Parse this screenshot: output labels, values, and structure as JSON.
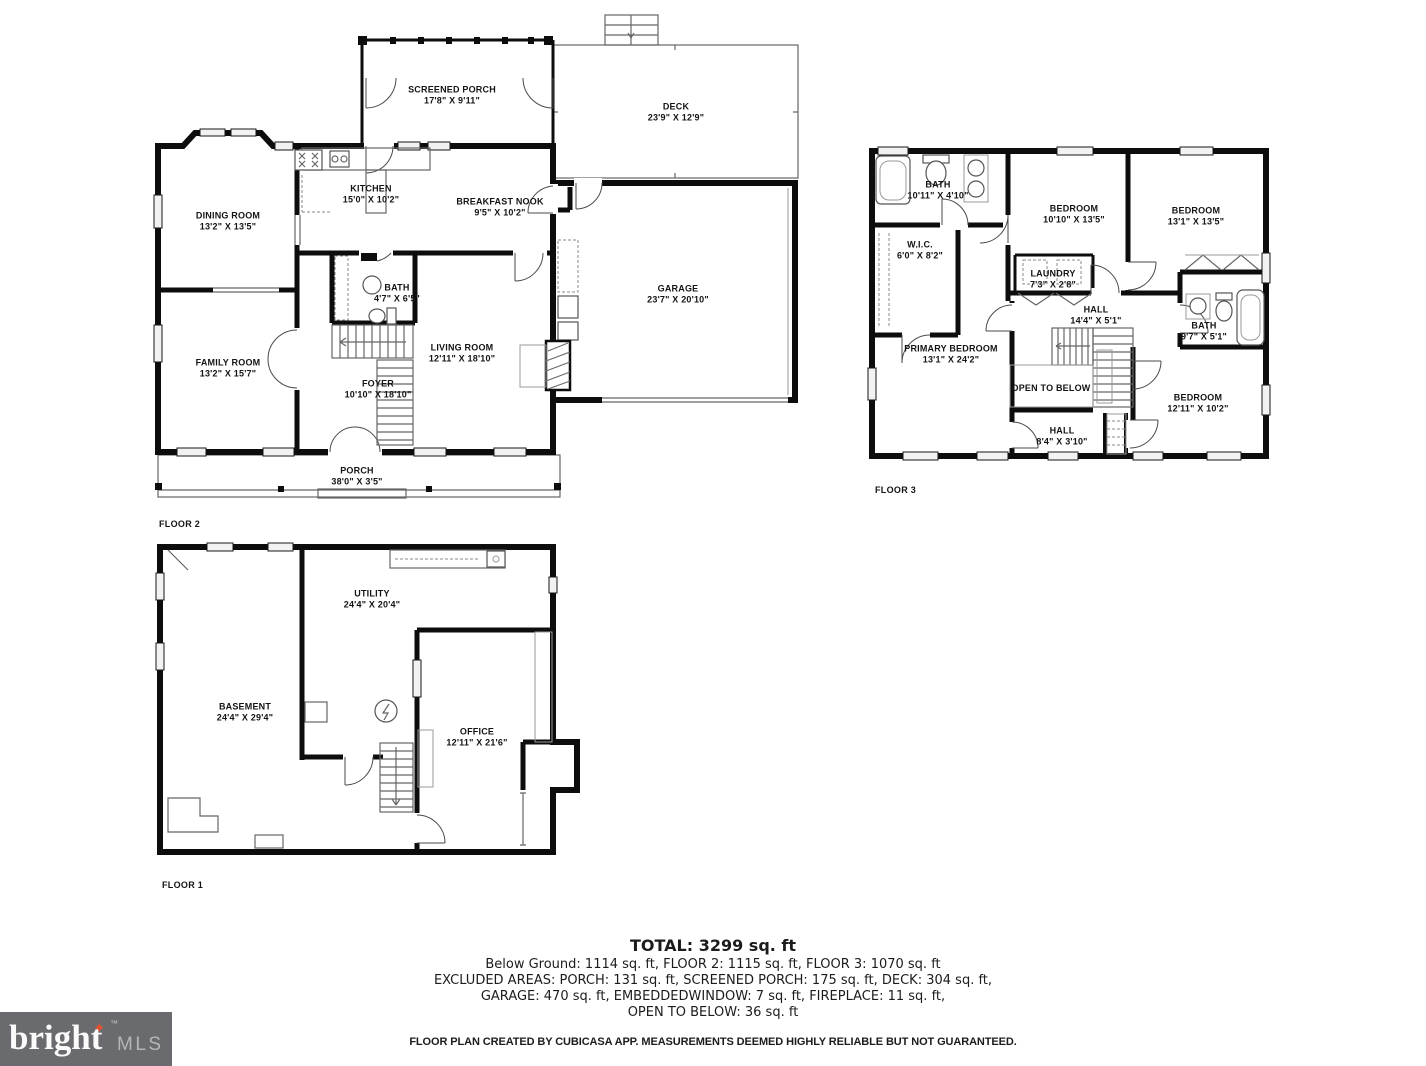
{
  "floors": [
    {
      "label": "FLOOR 2",
      "rooms": [
        {
          "name": "SCREENED PORCH",
          "dims": "17'8\" X 9'11\""
        },
        {
          "name": "DECK",
          "dims": "23'9\" X 12'9\""
        },
        {
          "name": "DINING ROOM",
          "dims": "13'2\" X 13'5\""
        },
        {
          "name": "KITCHEN",
          "dims": "15'0\" X 10'2\""
        },
        {
          "name": "BREAKFAST NOOK",
          "dims": "9'5\" X 10'2\""
        },
        {
          "name": "GARAGE",
          "dims": "23'7\" X 20'10\""
        },
        {
          "name": "BATH",
          "dims": "4'7\" X 6'5\""
        },
        {
          "name": "FAMILY ROOM",
          "dims": "13'2\" X 15'7\""
        },
        {
          "name": "LIVING ROOM",
          "dims": "12'11\" X 18'10\""
        },
        {
          "name": "FOYER",
          "dims": "10'10\" X 18'10\""
        },
        {
          "name": "PORCH",
          "dims": "38'0\" X 3'5\""
        }
      ]
    },
    {
      "label": "FLOOR 3",
      "rooms": [
        {
          "name": "BATH",
          "dims": "10'11\" X 4'10\""
        },
        {
          "name": "BEDROOM",
          "dims": "10'10\" X 13'5\""
        },
        {
          "name": "BEDROOM",
          "dims": "13'1\" X 13'5\""
        },
        {
          "name": "W.I.C.",
          "dims": "6'0\" X 8'2\""
        },
        {
          "name": "LAUNDRY",
          "dims": "7'3\" X 2'8\""
        },
        {
          "name": "HALL",
          "dims": "14'4\" X 5'1\""
        },
        {
          "name": "PRIMARY BEDROOM",
          "dims": "13'1\" X 24'2\""
        },
        {
          "name": "BATH",
          "dims": "9'7\" X 5'1\""
        },
        {
          "name": "OPEN TO BELOW",
          "dims": ""
        },
        {
          "name": "BEDROOM",
          "dims": "12'11\" X 10'2\""
        },
        {
          "name": "HALL",
          "dims": "8'4\" X 3'10\""
        }
      ]
    },
    {
      "label": "FLOOR 1",
      "rooms": [
        {
          "name": "UTILITY",
          "dims": "24'4\" X 20'4\""
        },
        {
          "name": "BASEMENT",
          "dims": "24'4\" X 29'4\""
        },
        {
          "name": "OFFICE",
          "dims": "12'11\" X 21'6\""
        }
      ]
    }
  ],
  "summary": {
    "total": "TOTAL: 3299 sq. ft",
    "line1": "Below Ground: 1114 sq. ft, FLOOR 2: 1115 sq. ft, FLOOR 3: 1070 sq. ft",
    "line2": "EXCLUDED AREAS: PORCH: 131 sq. ft, SCREENED PORCH: 175 sq. ft, DECK: 304 sq. ft,",
    "line3": "GARAGE: 470 sq. ft, EMBEDDEDWINDOW: 7 sq. ft, FIREPLACE: 11 sq. ft,",
    "line4": "OPEN TO BELOW: 36 sq. ft",
    "disclaimer": "FLOOR PLAN CREATED BY CUBICASA APP. MEASUREMENTS DEEMED HIGHLY RELIABLE BUT NOT GUARANTEED."
  },
  "logo": {
    "brand": "bright",
    "star": "✦",
    "tm": "™",
    "suffix": "MLS",
    "bg_color": "#6a6b6e",
    "star_color": "#e0532e"
  }
}
